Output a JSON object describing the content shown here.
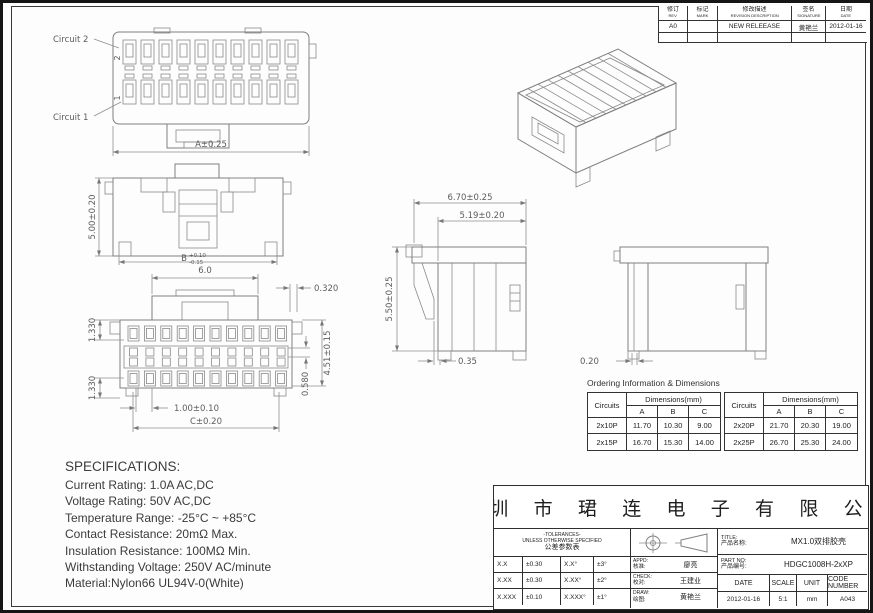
{
  "revision_table": {
    "headers": [
      {
        "zh": "修订",
        "en": "REV"
      },
      {
        "zh": "标记",
        "en": "MARK"
      },
      {
        "zh": "修改描述",
        "en": "REVISION DESCRIPTION"
      },
      {
        "zh": "签名",
        "en": "SIGNATURE"
      },
      {
        "zh": "日期",
        "en": "DATE"
      }
    ],
    "row1": {
      "rev": "A0",
      "mark": "",
      "description": "NEW RELEEASE",
      "signature": "黄艳兰",
      "date": "2012-01-16"
    },
    "row2": {
      "rev": "",
      "mark": "",
      "description": "",
      "signature": "",
      "date": ""
    }
  },
  "drawings": {
    "top_view": {
      "circuit2_label": "Circuit 2",
      "circuit1_label": "Circuit 1",
      "row2_mark": "2",
      "row1_mark": "1",
      "dim_a": "A±0.25"
    },
    "front_view": {
      "dim_height": "5.00±0.20",
      "dim_b_base": "B",
      "dim_b_plus": "+0.10",
      "dim_b_minus": "-0.15"
    },
    "face_view": {
      "dim_top": "6.0",
      "dim_gap": "0.320",
      "dim_pitch_top": "1.330",
      "dim_pitch_bottom": "1.330",
      "dim_mid": "0.580",
      "dim_height": "4.51±0.15",
      "dim_pitch": "1.00±0.10",
      "dim_c": "C±0.20"
    },
    "side_view": {
      "dim_width": "6.70±0.25",
      "dim_inner_width": "5.19±0.20",
      "dim_height": "5.50±0.25",
      "dim_foot": "0.35",
      "dim_gap": "0.20"
    }
  },
  "specifications": {
    "title": "SPECIFICATIONS:",
    "lines": [
      "Current Rating: 1.0A AC,DC",
      "Voltage Rating: 50V AC,DC",
      "Temperature Range: -25°C ~ +85°C",
      "Contact Resistance: 20mΩ Max.",
      "Insulation Resistance: 100MΩ Min.",
      "Withstanding Voltage: 250V AC/minute",
      "Material:Nylon66 UL94V-0(White)"
    ]
  },
  "ordering": {
    "title": "Ordering Information & Dimensions",
    "col_circuits": "Circuits",
    "col_dimensions": "Dimensions(mm)",
    "sub_a": "A",
    "sub_b": "B",
    "sub_c": "C",
    "left_rows": [
      {
        "circuits": "2x10P",
        "a": "11.70",
        "b": "10.30",
        "c": "9.00"
      },
      {
        "circuits": "2x15P",
        "a": "16.70",
        "b": "15.30",
        "c": "14.00"
      }
    ],
    "right_rows": [
      {
        "circuits": "2x20P",
        "a": "21.70",
        "b": "20.30",
        "c": "19.00"
      },
      {
        "circuits": "2x25P",
        "a": "26.70",
        "b": "25.30",
        "c": "24.00"
      }
    ]
  },
  "title_block": {
    "company": "深 圳 市 珺 连 电 子 有 限 公 司",
    "tolerances": {
      "header_line1": "-TOLERANCES-",
      "header_line2": "UNLESS OTHERWISE SPECIFIED",
      "header_line3": "公差参数表",
      "rows": [
        {
          "c1": "X.X",
          "v1": "±0.30",
          "c2": "X.X°",
          "v2": "±3°"
        },
        {
          "c1": "X.XX",
          "v1": "±0.30",
          "c2": "X.XX°",
          "v2": "±2°"
        },
        {
          "c1": "X.XXX",
          "v1": "±0.10",
          "c2": "X.XXX°",
          "v2": "±1°"
        }
      ]
    },
    "approvals": [
      {
        "en": "APPD:",
        "zh": "核准:",
        "name": "廖亮"
      },
      {
        "en": "CHECK:",
        "zh": "校对:",
        "name": "王建业"
      },
      {
        "en": "DRAW:",
        "zh": "绘图:",
        "name": "黄艳兰"
      }
    ],
    "title_label_en": "TITLE:",
    "title_label_zh": "产品名称:",
    "title_value": "MX1.0双排胶壳",
    "partno_label_en": "PART NO:",
    "partno_label_zh": "产品编号:",
    "partno_value": "HDGC1008H-2xXP",
    "date_label": "DATE",
    "date_value": "2012-01-16",
    "scale_label": "SCALE",
    "scale_value": "5:1",
    "unit_label": "UNIT",
    "unit_value": "mm",
    "code_label": "CODE NUMBER",
    "code_value": "A043"
  }
}
